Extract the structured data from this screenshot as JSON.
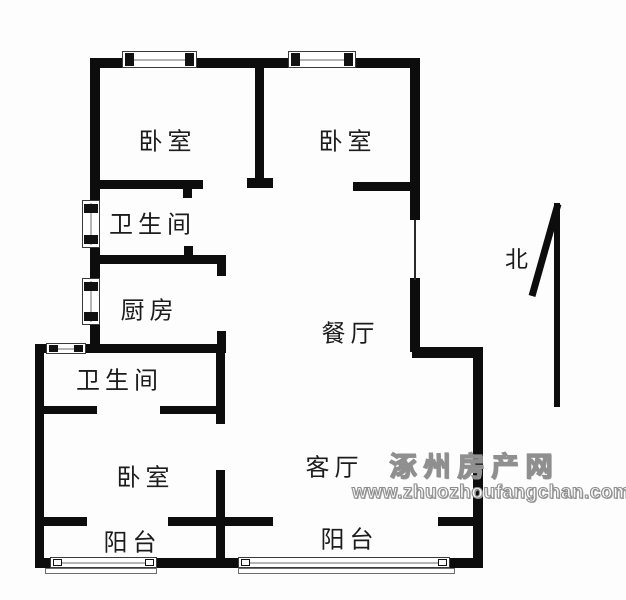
{
  "page": {
    "background": "#fdfdfd",
    "wall_color": "#0d0d0d"
  },
  "floorplan": {
    "rooms": [
      {
        "id": "bedroom-1",
        "label": "卧室",
        "cx": 165,
        "cy": 139
      },
      {
        "id": "bedroom-2",
        "label": "卧室",
        "cx": 345,
        "cy": 139
      },
      {
        "id": "bathroom-1",
        "label": "卫生间",
        "cx": 150,
        "cy": 222
      },
      {
        "id": "kitchen",
        "label": "厨房",
        "cx": 147,
        "cy": 308
      },
      {
        "id": "dining",
        "label": "餐厅",
        "cx": 348,
        "cy": 331
      },
      {
        "id": "bathroom-2",
        "label": "卫生间",
        "cx": 117,
        "cy": 378
      },
      {
        "id": "bedroom-3",
        "label": "卧室",
        "cx": 143,
        "cy": 475
      },
      {
        "id": "living",
        "label": "客厅",
        "cx": 332,
        "cy": 465
      },
      {
        "id": "balcony-1",
        "label": "阳台",
        "cx": 130,
        "cy": 540
      },
      {
        "id": "balcony-2",
        "label": "阳台",
        "cx": 347,
        "cy": 537
      }
    ],
    "walls": [
      {
        "name": "top-exterior-wall",
        "x": 90,
        "y": 58,
        "w": 330,
        "h": 10
      },
      {
        "name": "left-upper-exterior-wall",
        "x": 90,
        "y": 58,
        "w": 10,
        "h": 292
      },
      {
        "name": "kitchen-south-wall",
        "x": 35,
        "y": 344,
        "w": 191,
        "h": 9
      },
      {
        "name": "left-lower-exterior-wall",
        "x": 35,
        "y": 344,
        "w": 9,
        "h": 224
      },
      {
        "name": "bottom-left-corner-wall",
        "x": 35,
        "y": 558,
        "w": 15,
        "h": 10
      },
      {
        "name": "bottom-middle-wall",
        "x": 157,
        "y": 558,
        "w": 81,
        "h": 10
      },
      {
        "name": "bottom-right-corner-wall",
        "x": 450,
        "y": 558,
        "w": 33,
        "h": 10
      },
      {
        "name": "right-lower-exterior-wall",
        "x": 473,
        "y": 350,
        "w": 10,
        "h": 218
      },
      {
        "name": "right-jut-wall",
        "x": 412,
        "y": 347,
        "w": 71,
        "h": 11
      },
      {
        "name": "right-upper-wall-top",
        "x": 410,
        "y": 58,
        "w": 10,
        "h": 162
      },
      {
        "name": "right-upper-wall-bottom",
        "x": 410,
        "y": 278,
        "w": 10,
        "h": 74
      },
      {
        "name": "bedroom-divider-wall",
        "x": 255,
        "y": 68,
        "w": 9,
        "h": 112
      },
      {
        "name": "bedroom-divider-cap",
        "x": 247,
        "y": 178,
        "w": 26,
        "h": 10
      },
      {
        "name": "bedroom1-south-wall",
        "x": 100,
        "y": 180,
        "w": 103,
        "h": 9
      },
      {
        "name": "bedroom2-south-wall",
        "x": 353,
        "y": 182,
        "w": 59,
        "h": 9
      },
      {
        "name": "kitchen-north-wall",
        "x": 100,
        "y": 255,
        "w": 126,
        "h": 9
      },
      {
        "name": "kitchen-northeast-corner",
        "x": 217,
        "y": 264,
        "w": 9,
        "h": 12
      },
      {
        "name": "kitchen-east-wall",
        "x": 217,
        "y": 331,
        "w": 9,
        "h": 13
      },
      {
        "name": "bathroom2-east-wall",
        "x": 216,
        "y": 353,
        "w": 9,
        "h": 71
      },
      {
        "name": "bathroom2-south-wall-left",
        "x": 44,
        "y": 406,
        "w": 53,
        "h": 8
      },
      {
        "name": "bathroom2-south-wall-right",
        "x": 160,
        "y": 406,
        "w": 65,
        "h": 8
      },
      {
        "name": "bedroom3-east-wall",
        "x": 216,
        "y": 470,
        "w": 9,
        "h": 98
      },
      {
        "name": "bedroom3-south-wall",
        "x": 44,
        "y": 517,
        "w": 43,
        "h": 9
      },
      {
        "name": "balcony-divider-wall",
        "x": 168,
        "y": 517,
        "w": 105,
        "h": 9
      },
      {
        "name": "living-south-wall",
        "x": 438,
        "y": 517,
        "w": 35,
        "h": 9
      }
    ],
    "thin_lines": [
      {
        "name": "right-wall-window-line",
        "x": 414,
        "y": 220,
        "w": 2,
        "h": 60
      }
    ],
    "door_jambs": [
      {
        "name": "bedroom1-door-jamb",
        "x": 183,
        "y": 189,
        "w": 9,
        "h": 9
      },
      {
        "name": "bathroom1-door-jamb",
        "x": 184,
        "y": 246,
        "w": 9,
        "h": 9
      }
    ],
    "windows": [
      {
        "name": "bedroom1-top-window",
        "x": 122,
        "y": 51,
        "w": 75,
        "h": 17,
        "orient": "h",
        "jamb": "solid"
      },
      {
        "name": "bedroom2-top-window",
        "x": 288,
        "y": 51,
        "w": 68,
        "h": 17,
        "orient": "h",
        "jamb": "solid"
      },
      {
        "name": "bathroom1-left-window",
        "x": 82,
        "y": 200,
        "w": 18,
        "h": 48,
        "orient": "v",
        "jamb": "solid"
      },
      {
        "name": "kitchen-left-window",
        "x": 82,
        "y": 278,
        "w": 18,
        "h": 47,
        "orient": "v",
        "jamb": "solid"
      },
      {
        "name": "bathroom2-top-window",
        "x": 46,
        "y": 343,
        "w": 40,
        "h": 11,
        "orient": "h",
        "jamb": "solid"
      },
      {
        "name": "balcony1-window",
        "x": 50,
        "y": 557,
        "w": 107,
        "h": 11,
        "orient": "h",
        "jamb": "outline"
      },
      {
        "name": "balcony2-window",
        "x": 238,
        "y": 557,
        "w": 212,
        "h": 11,
        "orient": "h",
        "jamb": "outline"
      }
    ],
    "sills": [
      {
        "name": "balcony1-sill",
        "x": 45,
        "y": 568,
        "w": 112,
        "h": 6
      },
      {
        "name": "balcony2-sill",
        "x": 238,
        "y": 568,
        "w": 217,
        "h": 6
      }
    ],
    "compass": {
      "label": "北"
    },
    "watermark": {
      "line1": "涿州房产网",
      "line2": "www.zhuozhoufangchan.com",
      "color": "#8f8f8f"
    }
  }
}
